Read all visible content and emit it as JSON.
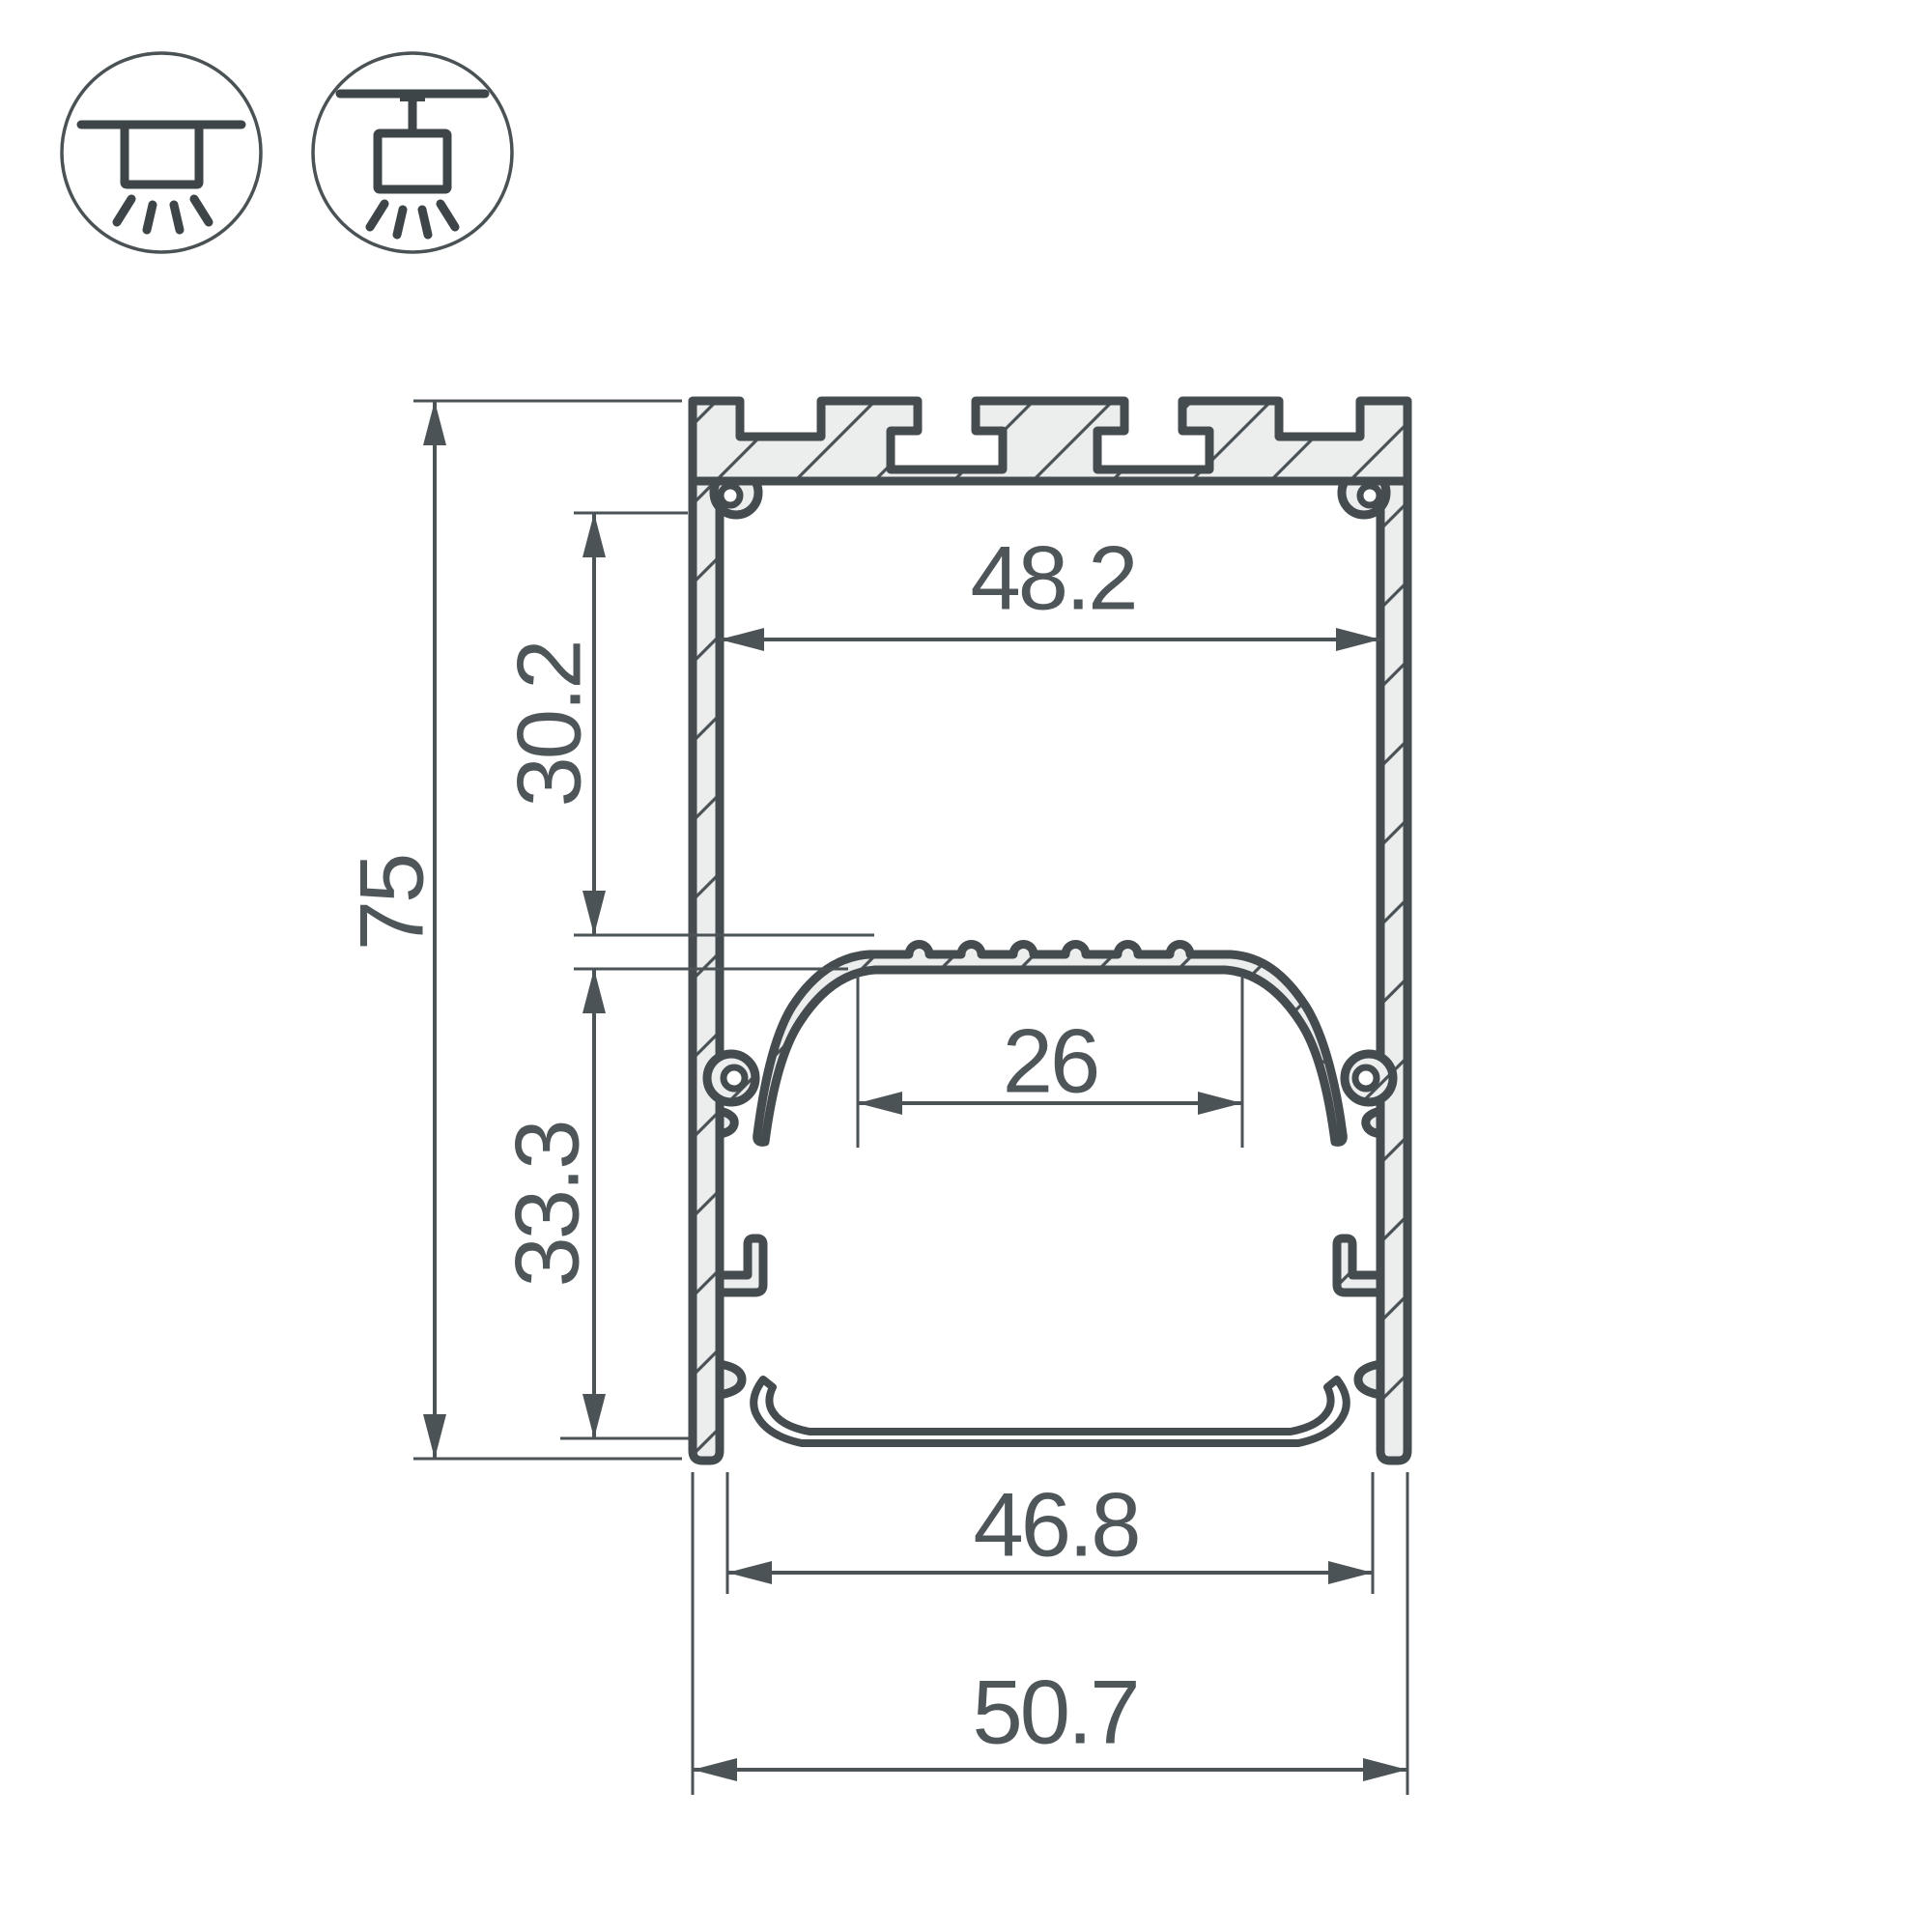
{
  "drawing": {
    "title": "aluminium-led-profile-cross-section",
    "dimensions": {
      "total_height": "75",
      "upper_cavity_height": "30.2",
      "lower_cavity_height": "33.3",
      "inner_top_width": "48.2",
      "led_shelf_width": "26",
      "inner_bottom_width": "46.8",
      "total_width": "50.7"
    },
    "icons": {
      "surface_mount": "surface-mount-light-icon",
      "pendant_mount": "pendant-mount-light-icon"
    },
    "colors": {
      "outline": "#454C50",
      "dimension_line": "#4C5357",
      "aluminium_fill": "#ECEDED",
      "text": "#4E565A",
      "background": "#FFFFFF"
    }
  }
}
